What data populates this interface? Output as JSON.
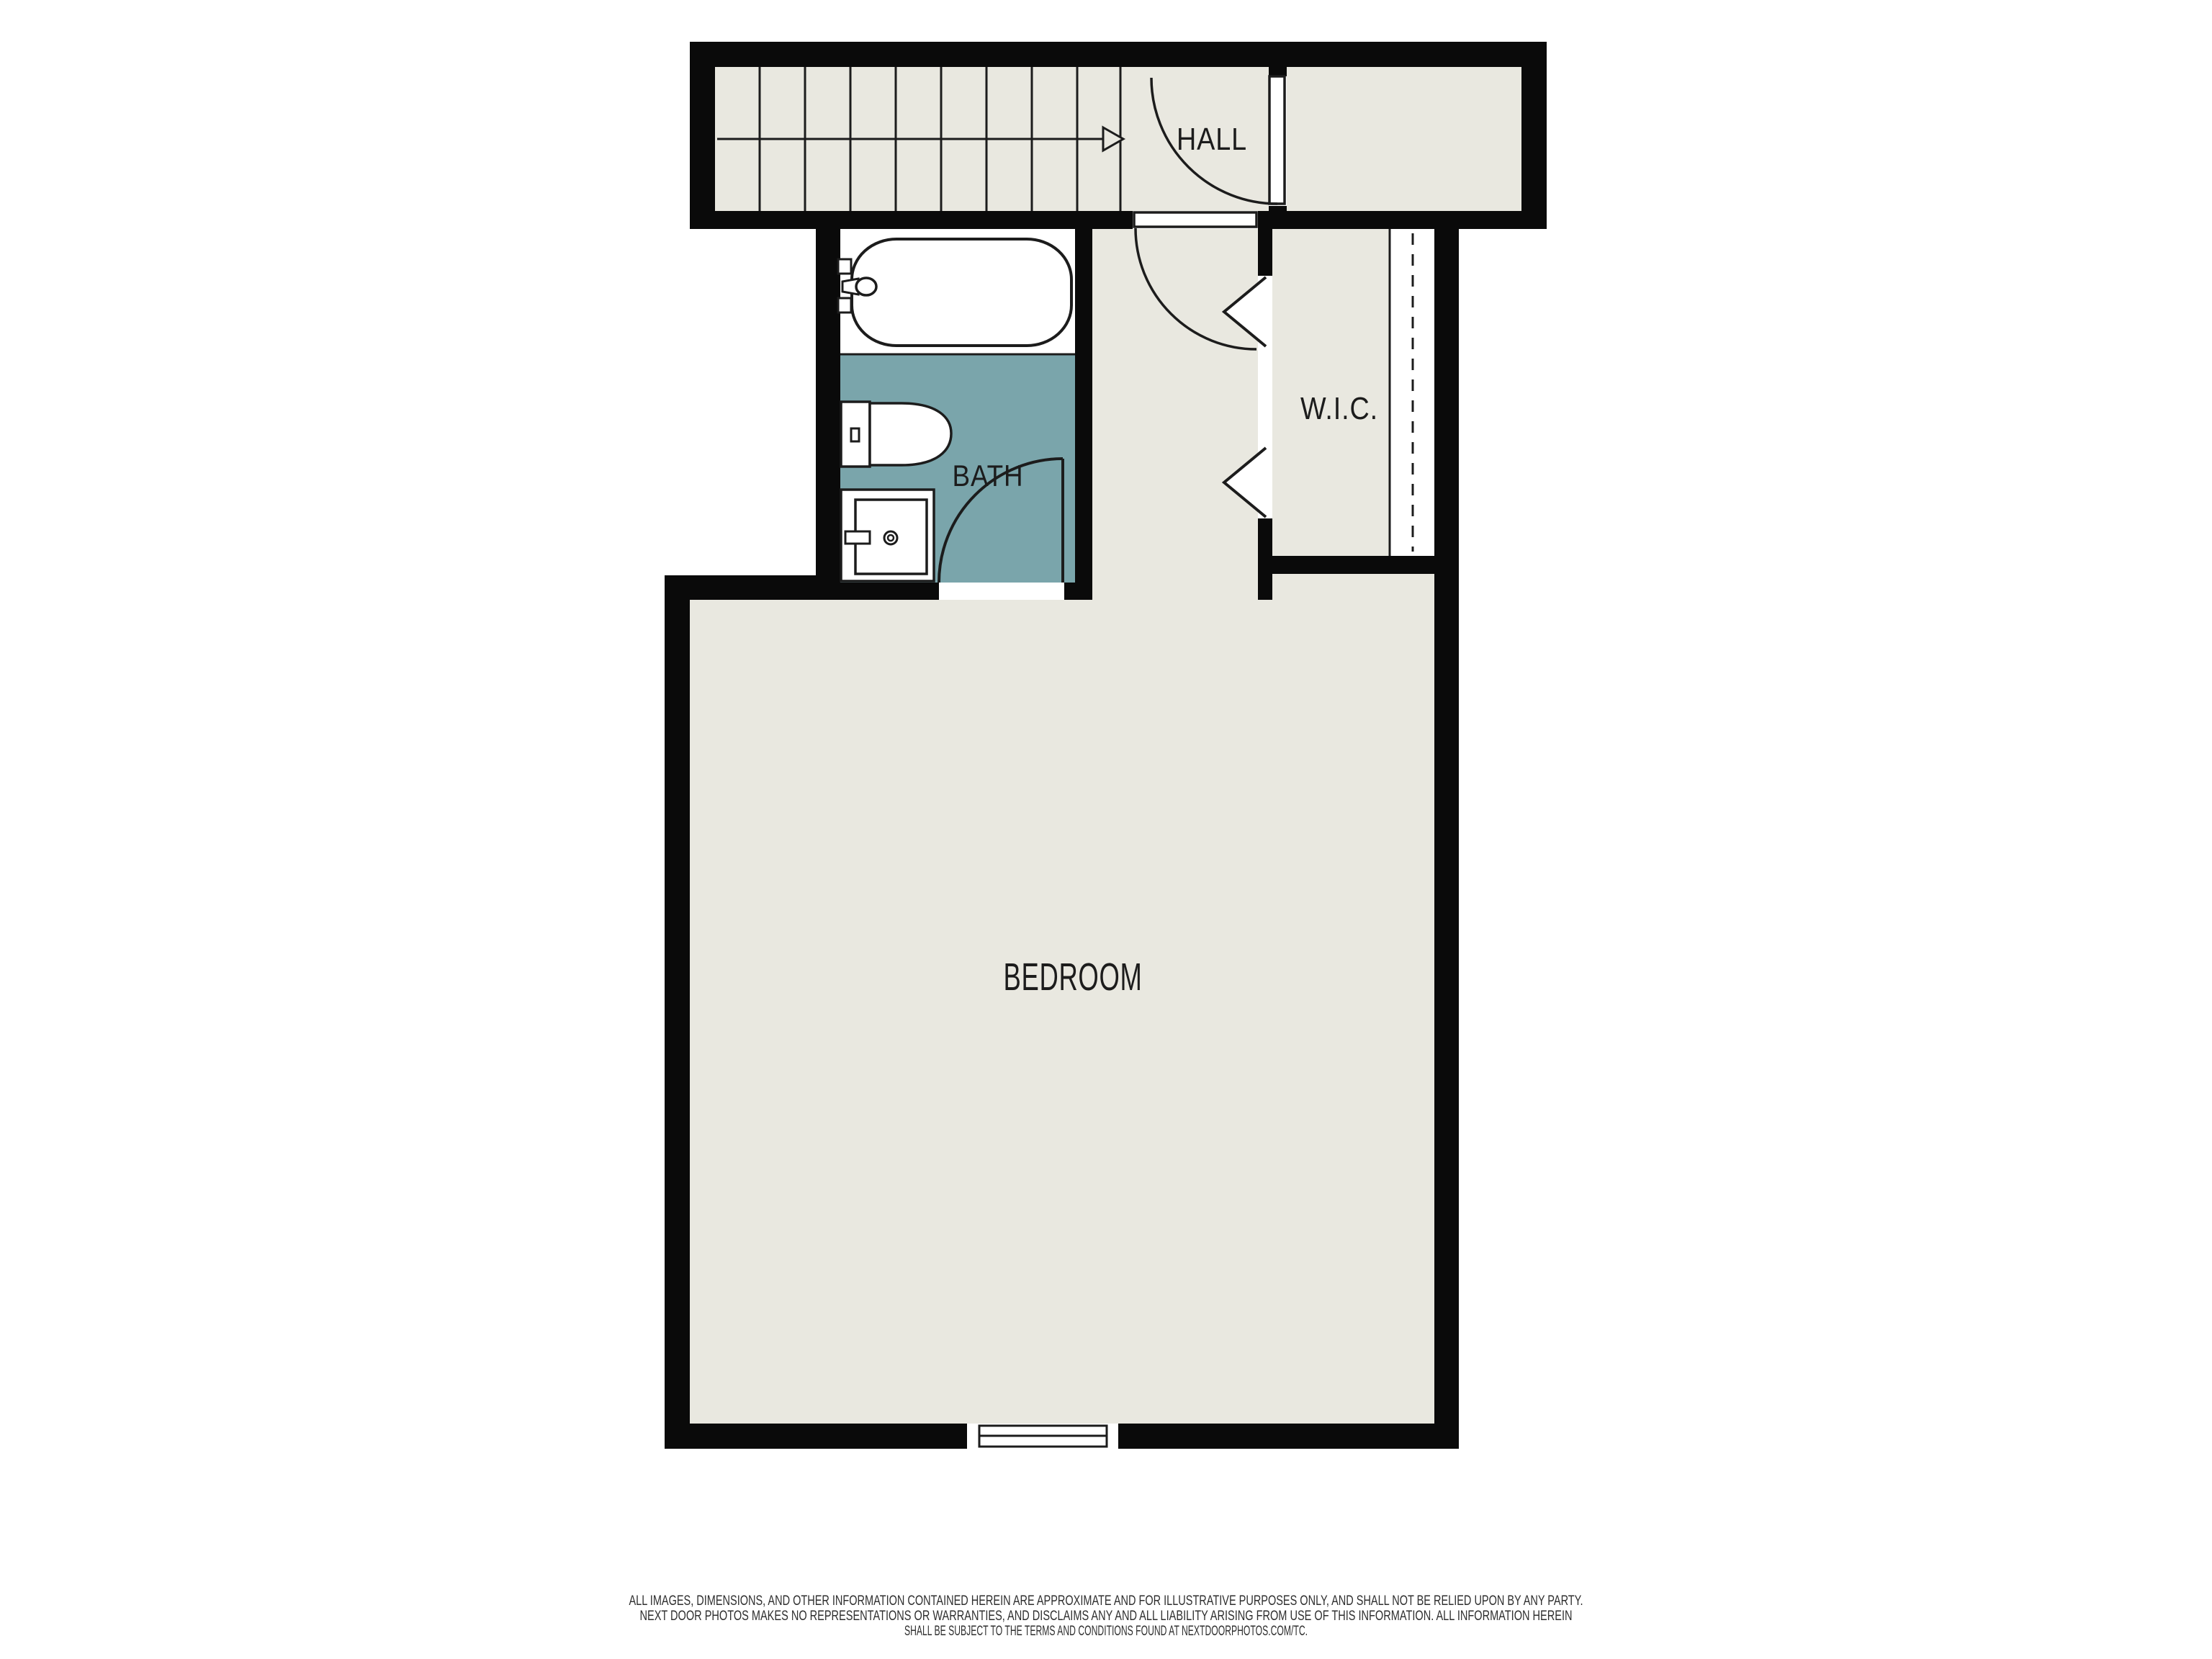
{
  "floor_plan": {
    "rooms": {
      "hall": {
        "label": "HALL"
      },
      "bath": {
        "label": "BATH"
      },
      "wic": {
        "label": "W.I.C."
      },
      "bedroom": {
        "label": "BEDROOM"
      }
    },
    "fixtures": [
      "staircase-with-up-arrow",
      "bathtub",
      "toilet",
      "sink-vanity",
      "closet-rod",
      "window",
      "hall-door",
      "corridor-door",
      "bath-door",
      "bifold-closet-doors"
    ],
    "colors": {
      "wall": "#0a0a0a",
      "floor": "#e9e8e0",
      "bath_floor": "#7aa5ab",
      "fixture_fill": "#ffffff",
      "background": "#ffffff",
      "line": "#1c1c1c"
    }
  },
  "disclaimer": {
    "line1": "ALL IMAGES, DIMENSIONS, AND OTHER INFORMATION CONTAINED HEREIN ARE APPROXIMATE AND FOR ILLUSTRATIVE PURPOSES ONLY, AND SHALL NOT BE RELIED UPON BY ANY PARTY.",
    "line2": "NEXT DOOR PHOTOS MAKES NO REPRESENTATIONS OR WARRANTIES, AND DISCLAIMS ANY AND ALL LIABILITY ARISING FROM USE OF THIS INFORMATION. ALL INFORMATION HEREIN",
    "line3": "SHALL BE SUBJECT TO THE TERMS AND CONDITIONS FOUND AT NEXTDOORPHOTOS.COM/TC."
  }
}
